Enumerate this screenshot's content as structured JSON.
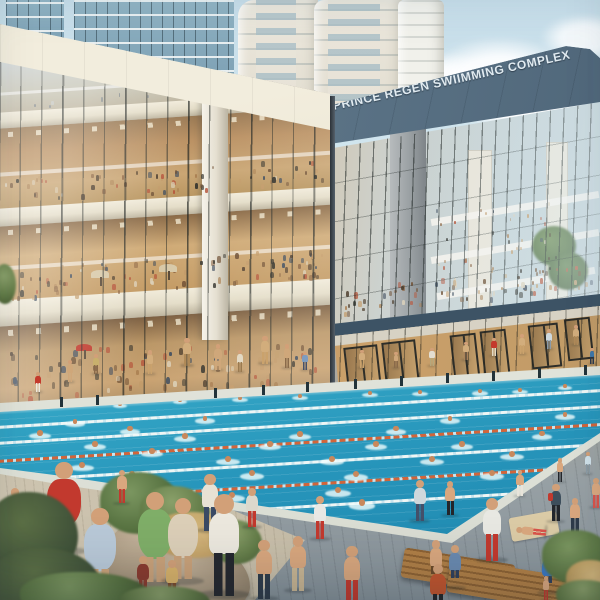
{
  "scene": {
    "sign": {
      "text": "PRINCE REGEN SWIIMMING COMPLEX"
    },
    "palette": {
      "sky": "#d7eaf1",
      "cloud": "#ffffff",
      "fascia_blue": "#5b7386",
      "fascia_cream": "#e9e4d3",
      "sign_letters": "#e1ebf1",
      "glass_interior_warm": "#c39a6d",
      "slab_white": "#ece6d8",
      "water_far": "#9ee2e8",
      "water_near": "#1f86ad",
      "lane_white": "#eef6f5",
      "lane_orange": "#d2653a",
      "coping": "#e8eae2",
      "deck_grey": "#97a0a4",
      "deck_warm": "#cfc6b2",
      "planter_stone": "#ab9a82",
      "bush_green": "#55703f",
      "grass_dry": "#c2a064",
      "lounger_wood": "#a2713f",
      "skin": "#d2a078"
    },
    "lane_lines_format": "yAtLeftEdge,color",
    "lane_lines": [
      [
        427,
        "#eef6f5"
      ],
      [
        443,
        "#eef6f5"
      ],
      [
        461,
        "#d2653a"
      ],
      [
        481,
        "#eef6f5"
      ],
      [
        503,
        "#d2653a"
      ],
      [
        525,
        "#eef6f5"
      ]
    ],
    "edge_posts_x": [
      60,
      96,
      214,
      262,
      306,
      354,
      400,
      446,
      492,
      538,
      584
    ],
    "swimmers_format": "x,y,scale",
    "swimmers": [
      [
        120,
        402,
        0.65
      ],
      [
        180,
        398,
        0.65
      ],
      [
        240,
        396,
        0.7
      ],
      [
        300,
        394,
        0.7
      ],
      [
        370,
        391,
        0.7
      ],
      [
        420,
        390,
        0.7
      ],
      [
        480,
        389,
        0.75
      ],
      [
        520,
        388,
        0.7
      ],
      [
        565,
        384,
        0.65
      ],
      [
        40,
        430,
        1
      ],
      [
        75,
        419,
        0.9
      ],
      [
        95,
        441,
        1
      ],
      [
        130,
        426,
        0.95
      ],
      [
        152,
        448,
        1
      ],
      [
        185,
        433,
        1
      ],
      [
        205,
        416,
        0.9
      ],
      [
        228,
        456,
        1.05
      ],
      [
        252,
        470,
        1.1
      ],
      [
        270,
        441,
        1
      ],
      [
        300,
        431,
        1
      ],
      [
        332,
        456,
        1.05
      ],
      [
        356,
        471,
        1.1
      ],
      [
        376,
        441,
        1
      ],
      [
        396,
        426,
        0.95
      ],
      [
        432,
        456,
        1.05
      ],
      [
        462,
        441,
        1
      ],
      [
        492,
        470,
        1.1
      ],
      [
        512,
        451,
        1.05
      ],
      [
        542,
        431,
        0.95
      ],
      [
        565,
        412,
        0.9
      ],
      [
        338,
        487,
        1.15
      ],
      [
        362,
        499,
        1.2
      ],
      [
        232,
        492,
        1.15
      ],
      [
        132,
        471,
        1.1
      ],
      [
        82,
        462,
        1.05
      ],
      [
        450,
        416,
        0.9
      ],
      [
        582,
        455,
        1
      ]
    ],
    "people_format": "x,y,height,topColor,bottomColor,type(stand|dress|sit|lie),accentColor",
    "people": [
      [
        38,
        372,
        20,
        "#c43a2c",
        "#ede8dc",
        "stand",
        null
      ],
      [
        70,
        360,
        22,
        "#cfa77a",
        "#cfa77a",
        "stand",
        null
      ],
      [
        96,
        354,
        20,
        "#c9b06d",
        "#8a6a4a",
        "stand",
        null
      ],
      [
        150,
        350,
        24,
        "#d2ad7c",
        "#caa26c",
        "stand",
        null
      ],
      [
        187,
        338,
        28,
        "#d2ad7c",
        "#b08a58",
        "stand",
        null
      ],
      [
        218,
        344,
        26,
        "#cfa77a",
        "#cfa77a",
        "stand",
        null
      ],
      [
        240,
        350,
        22,
        "#e3d9c4",
        "#9a7a50",
        "stand",
        null
      ],
      [
        265,
        336,
        28,
        "#d2ad7c",
        "#caa26c",
        "stand",
        null
      ],
      [
        287,
        344,
        24,
        "#cfa77a",
        "#8a6a4a",
        "stand",
        null
      ],
      [
        305,
        352,
        18,
        "#7d9cc0",
        "#44506a",
        "stand",
        null
      ],
      [
        362,
        350,
        18,
        "#d2ad7c",
        "#caa26c",
        "stand",
        null
      ],
      [
        396,
        352,
        16,
        "#cfa77a",
        "#8a6a4a",
        "stand",
        null
      ],
      [
        432,
        348,
        18,
        "#e3ded2",
        "#b5a77c",
        "stand",
        null
      ],
      [
        466,
        342,
        18,
        "#d2ad7c",
        "#a9825a",
        "stand",
        null
      ],
      [
        494,
        338,
        18,
        "#c43a2c",
        "#e3d9c4",
        "stand",
        null
      ],
      [
        522,
        334,
        20,
        "#d2ad7c",
        "#caa26c",
        "stand",
        null
      ],
      [
        549,
        329,
        20,
        "#cfd9de",
        "#8a9aa8",
        "stand",
        null
      ],
      [
        576,
        325,
        20,
        "#d2ad7c",
        "#b08a58",
        "stand",
        null
      ],
      [
        592,
        348,
        16,
        "#3f77a8",
        "#2c3a4c",
        "stand",
        null
      ],
      [
        64,
        462,
        92,
        "#c2392e",
        "#c2392e",
        "dress",
        null
      ],
      [
        100,
        508,
        90,
        "#b9c9d8",
        "#b9c9d8",
        "dress",
        null
      ],
      [
        155,
        492,
        96,
        "#7fae68",
        "#7fae68",
        "dress",
        null
      ],
      [
        183,
        498,
        86,
        "#dccfb8",
        "#c9b694",
        "dress",
        null
      ],
      [
        210,
        474,
        58,
        "#e8e2d4",
        "#3a4a64",
        "stand",
        null
      ],
      [
        224,
        494,
        104,
        "#ece8de",
        "#25282e",
        "stand",
        null
      ],
      [
        143,
        556,
        42,
        "#8a3b2f",
        "#8a3b2f",
        "stand",
        null
      ],
      [
        172,
        560,
        40,
        "#d8b26a",
        "#7a4a2c",
        "stand",
        null
      ],
      [
        32,
        494,
        40,
        "#4a6b8a",
        "#3a4a5a",
        "stand",
        null
      ],
      [
        46,
        514,
        38,
        "#c8b49a",
        "#8a6a4a",
        "stand",
        null
      ],
      [
        15,
        488,
        46,
        "#b8c6cc",
        "#6a7a84",
        "dress",
        null
      ],
      [
        252,
        488,
        40,
        "#dcd8cc",
        "#c2392e",
        "stand",
        null
      ],
      [
        122,
        470,
        34,
        "#d9a77e",
        "#c2392e",
        "stand",
        null
      ],
      [
        264,
        540,
        60,
        "#d9a77e",
        "#2e3b4a",
        "stand",
        null
      ],
      [
        298,
        536,
        56,
        "#d9a77e",
        "#c9b694",
        "stand",
        null
      ],
      [
        320,
        496,
        44,
        "#e8e8e4",
        "#c2392e",
        "stand",
        null
      ],
      [
        352,
        546,
        60,
        "#d9a77e",
        "#c2392e",
        "stand",
        null
      ],
      [
        420,
        480,
        42,
        "#cfd8dc",
        "#44506a",
        "stand",
        null
      ],
      [
        450,
        481,
        35,
        "#d9a77e",
        "#23262b",
        "stand",
        null
      ],
      [
        492,
        498,
        64,
        "#e8e8e2",
        "#c2392e",
        "stand",
        null
      ],
      [
        556,
        484,
        38,
        "#3d4e5c",
        "#23262b",
        "stand",
        "#c2392e"
      ],
      [
        575,
        498,
        36,
        "#d9a77e",
        "#2e3b4a",
        "stand",
        null
      ],
      [
        438,
        564,
        54,
        "#c2552e",
        "#23262b",
        "stand",
        null
      ],
      [
        436,
        540,
        46,
        "#d9a77e",
        "#6a4a2a",
        "sit",
        null
      ],
      [
        455,
        545,
        44,
        "#6a8ab0",
        "#30405c",
        "sit",
        null
      ],
      [
        548,
        552,
        42,
        "#3a77c2",
        "#30405c",
        "sit",
        null
      ],
      [
        577,
        550,
        50,
        "#2b3a44",
        "#2b3a44",
        "sit",
        null
      ],
      [
        531,
        516,
        30,
        "#d9a77e",
        "#d9534a",
        "lie",
        null
      ],
      [
        520,
        470,
        26,
        "#d9a77e",
        "#e8e4da",
        "stand",
        null
      ],
      [
        596,
        478,
        30,
        "#d9a77e",
        "#d9534a",
        "stand",
        null
      ],
      [
        560,
        458,
        24,
        "#d9a77e",
        "#23262b",
        "stand",
        null
      ],
      [
        588,
        452,
        22,
        "#cfe0e8",
        "#8a9aa4",
        "stand",
        null
      ],
      [
        546,
        576,
        24,
        "#d9a77e",
        "#c2392e",
        "stand",
        null
      ]
    ],
    "crowds_format": "layer,x,width,yTop,bandHeight,slope,count,sizeMin,sizeMax,palette",
    "crowds": [
      [
        "left",
        2,
        326,
        178,
        24,
        -0.067,
        70,
        2,
        3.5,
        "warm"
      ],
      [
        "left",
        2,
        326,
        268,
        30,
        -0.067,
        95,
        2,
        4,
        "warm"
      ],
      [
        "left",
        2,
        328,
        352,
        46,
        -0.055,
        85,
        2.5,
        4.5,
        "warm"
      ],
      [
        "left",
        30,
        290,
        96,
        14,
        -0.067,
        25,
        1.6,
        2.6,
        "light"
      ],
      [
        "right",
        338,
        256,
        288,
        26,
        -0.105,
        75,
        2,
        3.6,
        "warm"
      ],
      [
        "right",
        342,
        254,
        346,
        42,
        -0.115,
        70,
        2.5,
        4.5,
        "warm"
      ],
      [
        "right",
        436,
        160,
        316,
        14,
        -0.105,
        25,
        2,
        3,
        "warm"
      ],
      [
        "right",
        432,
        126,
        205,
        72,
        -0.05,
        35,
        1.6,
        2.4,
        "warm"
      ]
    ],
    "crowd_palettes": {
      "warm": [
        "#6e4f33",
        "#8a6240",
        "#a87d4f",
        "#c29a68",
        "#4a3a2a",
        "#3c4a5c",
        "#b5543a",
        "#ddd2ba",
        "#2e2e28"
      ],
      "light": [
        "#9aa4aa",
        "#b9c2c6",
        "#8a8f93",
        "#c9d0d2",
        "#7a8288"
      ]
    },
    "umbrellas_format": "layer,x,y,width,color",
    "umbrellas": [
      [
        "left",
        84,
        344,
        16,
        "#c03a2c"
      ],
      [
        "left",
        100,
        270,
        18,
        "#d8c9a8"
      ],
      [
        "left",
        168,
        264,
        18,
        "#d8c9a8"
      ]
    ]
  }
}
